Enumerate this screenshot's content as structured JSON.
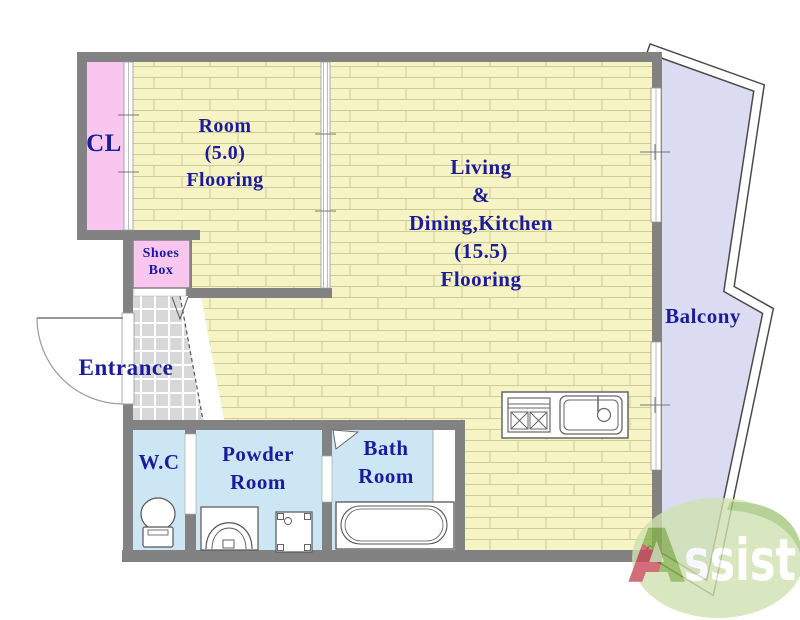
{
  "title": "Apartment floor plan",
  "colors": {
    "wall": "#828282",
    "flooring_bg": "#f6f3c4",
    "flooring_line": "#cfcb97",
    "closet_pink": "#f9c6ef",
    "shoes_pink": "#f9c6ef",
    "wet_room_blue": "#cde6f4",
    "balcony_floor": "#dbdbf2",
    "entrance_tile": "#d8d8d8",
    "label_blue": "#1b1b9b",
    "logo_ellipse_green": "#cfe2b0",
    "logo_leaf_green": "#a5c87c",
    "logo_letter_green": "#86b14e",
    "logo_letter_red": "#c84a5a",
    "logo_text_white": "#ffffff"
  },
  "rooms": {
    "closet": {
      "label": "CL"
    },
    "bedroom": {
      "line1": "Room",
      "line2": "(5.0)",
      "line3": "Flooring"
    },
    "ldk": {
      "line1": "Living",
      "line2": "&",
      "line3": "Dining,Kitchen",
      "line4": "(15.5)",
      "line5": "Flooring"
    },
    "balcony": {
      "label": "Balcony"
    },
    "shoes_box": {
      "line1": "Shoes",
      "line2": "Box"
    },
    "entrance": {
      "label": "Entrance"
    },
    "wc": {
      "label": "W.C"
    },
    "powder": {
      "line1": "Powder",
      "line2": "Room"
    },
    "bath": {
      "line1": "Bath",
      "line2": "Room"
    }
  },
  "logo": {
    "letter": "A",
    "rest": "ssist"
  }
}
